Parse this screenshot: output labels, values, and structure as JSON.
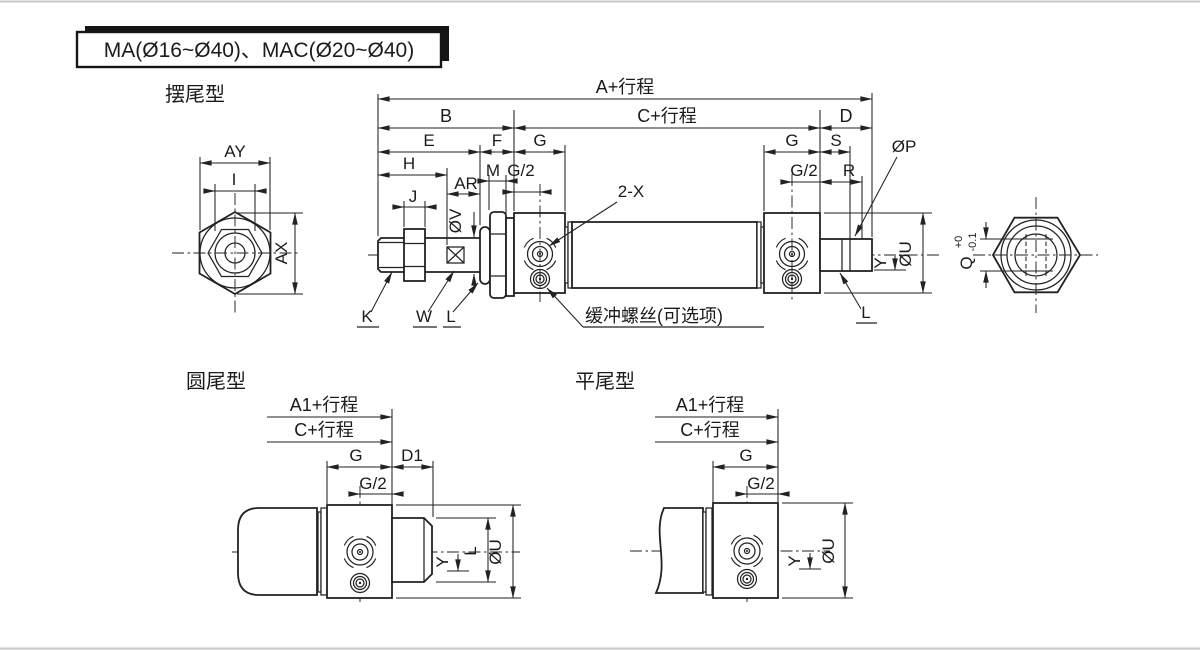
{
  "title": {
    "text": "MA(Ø16~Ø40)、MAC(Ø20~Ø40)"
  },
  "views": {
    "swing": {
      "heading": "摆尾型",
      "dims": {
        "a": "A+行程",
        "b": "B",
        "c": "C+行程",
        "d": "D",
        "e": "E",
        "f": "F",
        "g_left": "G",
        "g_half_left": "G/2",
        "h": "H",
        "ar": "AR",
        "m": "M",
        "j": "J",
        "ov": "ØV",
        "g_right": "G",
        "g_half_right": "G/2",
        "s": "S",
        "r": "R",
        "op": "ØP",
        "ou": "ØU",
        "y": "Y",
        "l_boss": "L",
        "k": "K",
        "w": "W",
        "l_washer": "L",
        "two_x": "2-X",
        "cushion_note": "缓冲螺丝(可选项)"
      },
      "front_view": {
        "ay": "AY",
        "i": "I",
        "ax": "AX"
      },
      "end_view": {
        "q": "Q",
        "q_tol_upper": "+0",
        "q_tol_lower": "-0.1"
      }
    },
    "round": {
      "heading": "圆尾型",
      "dims": {
        "a1": "A1+行程",
        "c": "C+行程",
        "g": "G",
        "d1": "D1",
        "g_half": "G/2",
        "ou": "ØU",
        "l": "L",
        "y": "Y"
      }
    },
    "flat": {
      "heading": "平尾型",
      "dims": {
        "a1": "A1+行程",
        "c": "C+行程",
        "g": "G",
        "g_half": "G/2",
        "ou": "ØU",
        "y": "Y"
      }
    }
  }
}
